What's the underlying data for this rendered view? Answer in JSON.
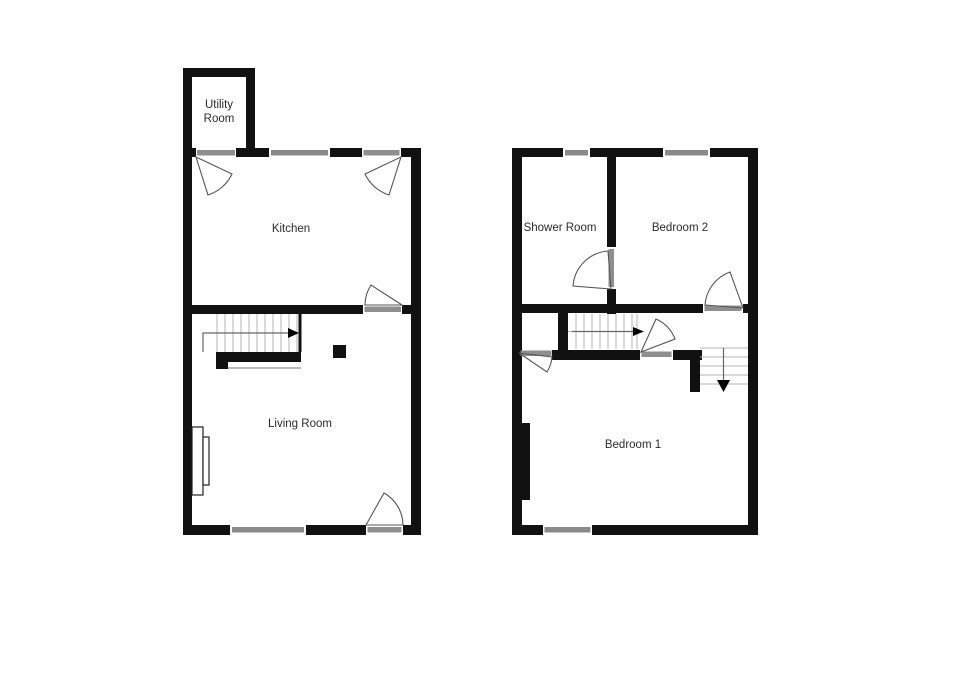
{
  "floor_plan": {
    "ground_floor": {
      "rooms": {
        "utility": {
          "label": "Utility Room",
          "line1": "Utility",
          "line2": "Room"
        },
        "kitchen": {
          "label": "Kitchen"
        },
        "living_room": {
          "label": "Living Room"
        }
      },
      "features": {
        "stairs_direction_icon": "arrow-right-icon",
        "window_count": 2,
        "door_count": 4
      }
    },
    "first_floor": {
      "rooms": {
        "shower_room": {
          "label": "Shower Room"
        },
        "bedroom_2": {
          "label": "Bedroom 2"
        },
        "bedroom_1": {
          "label": "Bedroom 1"
        }
      },
      "features": {
        "stairs_up_icon": "arrow-right-icon",
        "stairs_down_icon": "arrow-down-icon",
        "window_count": 3,
        "door_count": 4
      }
    }
  },
  "colors": {
    "background": "#ffffff",
    "wall": "#111111",
    "window": "#8a8a8a",
    "door_sill": "#8f8f8f",
    "door_arc": "#555555",
    "stair_tread": "#b4b4b4",
    "label_text": "#2b2b2b"
  }
}
